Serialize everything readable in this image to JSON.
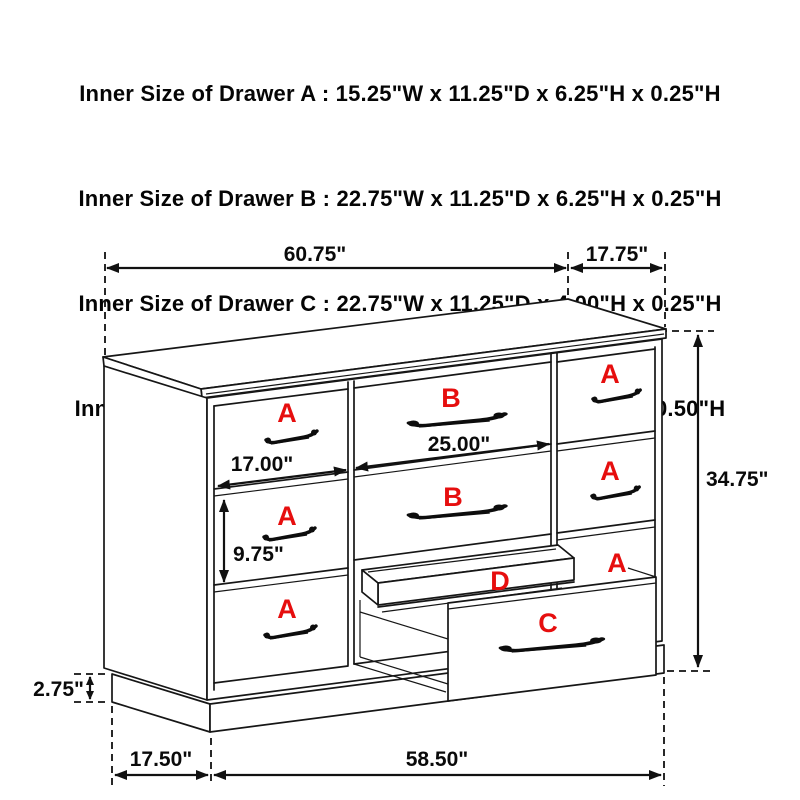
{
  "title_block": {
    "lines": [
      "Inner Size of Drawer A : 15.25\"W x 11.25\"D x 6.25\"H x 0.25\"H",
      "Inner Size of Drawer B : 22.75\"W x 11.25\"D x 6.25\"H x 0.25\"H",
      "Inner Size of Drawer C : 22.75\"W x 11.25\"D x 4.00\"H x 0.25\"H",
      "Inner Size of Drawer  D : 22.50\"W x 10.75\"D x 1.75\"H x 0.50\"H"
    ]
  },
  "dimensions": {
    "top_width": "60.75\"",
    "top_depth": "17.75\"",
    "overall_height": "34.75\"",
    "left_drawer_width": "17.00\"",
    "center_drawer_width": "25.00\"",
    "left_drawer_height": "9.75\"",
    "base_height": "2.75\"",
    "base_depth": "17.50\"",
    "base_width": "58.50\""
  },
  "drawer_labels": {
    "a": "A",
    "b": "B",
    "c": "C",
    "d": "D"
  },
  "colors": {
    "label_red": "#e60e0e",
    "line_black": "#161616"
  }
}
